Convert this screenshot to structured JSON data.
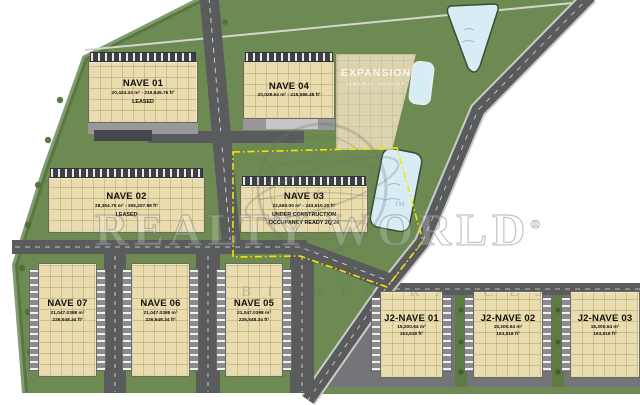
{
  "plan": {
    "title": "Industrial park site plan",
    "palette": {
      "site_green": "#6c8a51",
      "road_gray": "#5a5b5d",
      "building_tan": "#e9dcae",
      "pond_blue": "#d6edf6",
      "parcel_boundary_yellow": "#f7e600"
    }
  },
  "watermark": {
    "brand": "REALTY WORLD",
    "registered": "®",
    "trademark": "™",
    "tagline": "BIENES RAÍCES"
  },
  "buildings": {
    "nave01": {
      "name": "NAVE 01",
      "area": "20,424.34 m² - 219,845.76 ft²",
      "status": "LEASED"
    },
    "nave02": {
      "name": "NAVE 02",
      "area": "28,354.75 m² - 305,207.98 ft²",
      "status": "LEASED"
    },
    "nave03": {
      "name": "NAVE 03",
      "area": "22,660.00 m² - 243,910.20 ft²",
      "status": "UNDER CONSTRUCTION",
      "status2": "OCCUPANCY READY 2Q'26"
    },
    "nave04": {
      "name": "NAVE 04",
      "area": "20,028.64 m² - 215,586.48 ft²"
    },
    "expansion": {
      "name": "EXPANSION",
      "area": "13,952.46 m² - 150,182.36 ft²"
    },
    "nave05": {
      "name": "NAVE 05",
      "area_m2": "21,047.0398 m²",
      "area_ft2": "226,548.34 ft²"
    },
    "nave06": {
      "name": "NAVE 06",
      "area_m2": "21,047.0398 m²",
      "area_ft2": "226,548.34 ft²"
    },
    "nave07": {
      "name": "NAVE 07",
      "area_m2": "21,047.0398 m²",
      "area_ft2": "226,548.34 ft²"
    },
    "j2nave01": {
      "name": "J2-NAVE 01",
      "area_m2": "15,200.64 m²",
      "area_ft2": "163,618 ft²"
    },
    "j2nave02": {
      "name": "J2-NAVE 02",
      "area_m2": "15,200.64 m²",
      "area_ft2": "163,618 ft²"
    },
    "j2nave03": {
      "name": "J2-NAVE 03",
      "area_m2": "15,200.64 m²",
      "area_ft2": "163,618 ft²"
    }
  }
}
